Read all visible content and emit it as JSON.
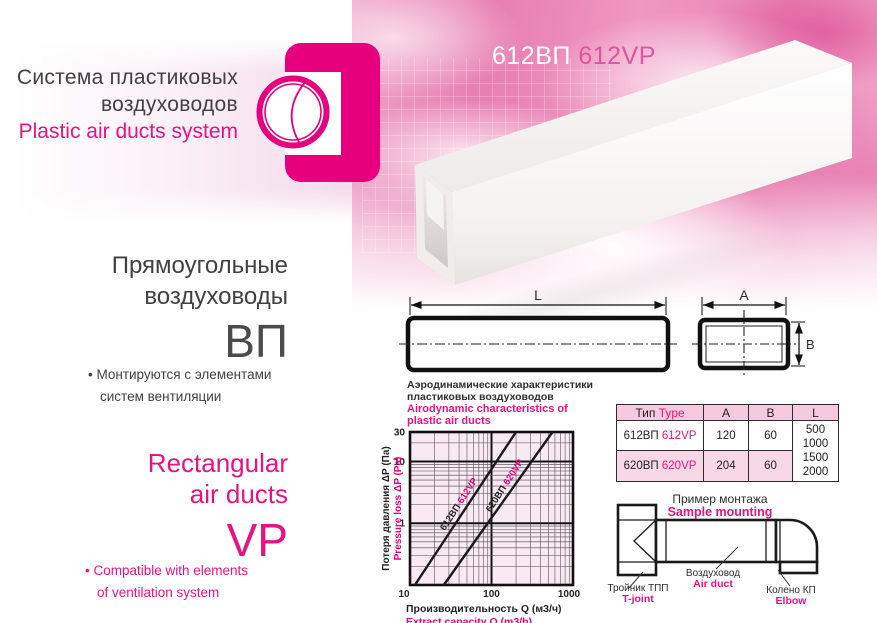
{
  "colors": {
    "magenta": "#e6007e",
    "magenta_text": "#e81383",
    "title_pink": "#e1549f",
    "dark": "#3f3f3f"
  },
  "brand": {
    "line1_ru": "Система пластиковых",
    "line2_ru": "воздуховодов",
    "line_en": "Plastic air ducts system"
  },
  "product": {
    "code_ru": "612ВП",
    "code_en": "612VP"
  },
  "intro_ru": {
    "heading1": "Прямоугольные",
    "heading2": "воздуховоды",
    "code": "ВП",
    "bullet_line1": "• Монтируются с элементами",
    "bullet_line2": "систем вентиляции"
  },
  "intro_en": {
    "heading1": "Rectangular",
    "heading2": "air ducts",
    "code": "VP",
    "bullet_line1": "• Compatible with elements",
    "bullet_line2": "of ventilation system"
  },
  "dimension_labels": {
    "length": "L",
    "width": "A",
    "height": "B"
  },
  "chart_data": {
    "type": "line",
    "title_ru_line1": "Аэродинамические характеристики",
    "title_ru_line2": "пластиковых воздуховодов",
    "title_en_line1": "Airodynamic characteristics of",
    "title_en_line2": "plastic air ducts",
    "xlabel_ru": "Производительность Q (м3/ч)",
    "xlabel_en": "Extract capacity Q (m3/h)",
    "ylabel_ru": "Потеря давления ΔP (Па)",
    "ylabel_en": "Pressure loss ΔP (Pa)",
    "x_scale": "log",
    "y_scale": "log",
    "xlim": [
      10,
      1000
    ],
    "ylim": [
      0.1,
      30
    ],
    "x_ticks": [
      10,
      100,
      1000
    ],
    "y_ticks": [
      30,
      10,
      1
    ],
    "grid": true,
    "legend_position": "on-line",
    "series": [
      {
        "name_ru": "612ВП",
        "name_en": "612VP",
        "points": [
          [
            11.5,
            0.1
          ],
          [
            200,
            30
          ]
        ]
      },
      {
        "name_ru": "620ВП",
        "name_en": "620VP",
        "points": [
          [
            26,
            0.1
          ],
          [
            560,
            30
          ]
        ]
      }
    ]
  },
  "table": {
    "header": {
      "type_ru": "Тип",
      "type_en": "Type",
      "col_a": "A",
      "col_b": "B",
      "col_l": "L"
    },
    "rows": [
      {
        "code_ru": "612ВП",
        "code_en": "612VP",
        "a": "120",
        "b": "60"
      },
      {
        "code_ru": "620ВП",
        "code_en": "620VP",
        "a": "204",
        "b": "60"
      }
    ],
    "l_values": [
      "500",
      "1000",
      "1500",
      "2000"
    ]
  },
  "mounting": {
    "title_ru": "Пример монтажа",
    "title_en": "Sample mounting",
    "tjoint_ru": "Тройник ТПП",
    "tjoint_en": "T-joint",
    "duct_ru": "Воздуховод",
    "duct_en": "Air duct",
    "elbow_ru": "Колено КП",
    "elbow_en": "Elbow"
  }
}
